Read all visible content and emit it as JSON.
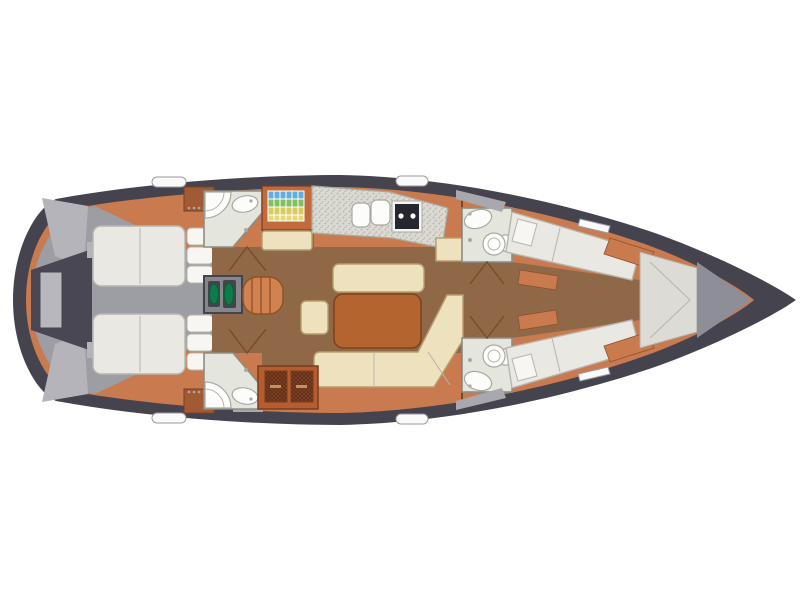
{
  "diagram": {
    "title": "Sailboat interior layout plan (top view, bow to the right)",
    "orientation": "bow-right",
    "areas": [
      {
        "id": "swim-platform",
        "label": "stern transom / swim platform"
      },
      {
        "id": "cockpit",
        "label": "cockpit deck"
      },
      {
        "id": "aft-cabin-top",
        "label": "aft double berth cabin (port)"
      },
      {
        "id": "aft-cabin-bottom",
        "label": "aft double berth cabin (starboard)"
      },
      {
        "id": "aft-head-top",
        "label": "aft head with corner shower and basin"
      },
      {
        "id": "aft-head-bottom",
        "label": "aft head with corner shower and basin"
      },
      {
        "id": "nav-station",
        "label": "chart table with colored chart grid and seat"
      },
      {
        "id": "galley",
        "label": "galley with double sink and two-burner stove"
      },
      {
        "id": "saloon",
        "label": "saloon with U-shaped settee and table"
      },
      {
        "id": "companionway",
        "label": "companionway steps"
      },
      {
        "id": "engine-compartment",
        "label": "engine compartment hatch"
      },
      {
        "id": "storage-cabinet",
        "label": "louvered storage lockers"
      },
      {
        "id": "forward-head-top",
        "label": "forward head with toilet and basin"
      },
      {
        "id": "forward-head-bottom",
        "label": "forward head with toilet and basin"
      },
      {
        "id": "forward-berth-top",
        "label": "forward berth (angled)"
      },
      {
        "id": "forward-berth-bottom",
        "label": "forward berth (angled)"
      },
      {
        "id": "anchor-locker",
        "label": "bow anchor locker"
      }
    ]
  },
  "colors": {
    "background": "#ffffff",
    "hull": "#45444e",
    "cockpit": "#9d9da4",
    "cockpit_panel": "#b4b4ba",
    "transom": "#484753",
    "transom_inner": "#b7b7bd",
    "floor_orange": "#c97a4e",
    "floor_brown": "#8f6947",
    "steps": "#d0824f",
    "steps_edge": "#8f5128",
    "cream": "#eee1bd",
    "cream_edge": "#b59e6e",
    "table": "#b4652f",
    "table_edge": "#7f431c",
    "bed": "#e9e8e3",
    "bed_edge": "#b6b5af",
    "pillow": "#f7f6f2",
    "head_floor": "#e4e6dd",
    "wall": "#8d8d84",
    "fixture": "#fcfcfa",
    "fixture_edge": "#a9a9a1",
    "counter": "#dbdad2",
    "counter_dot": "#b4b3aa",
    "stove": "#26262e",
    "stove_frame": "#f4f4f2",
    "cabinet": "#b55c31",
    "cabinet_edge": "#7a3c1c",
    "door_panel": "#7e3f22",
    "door_line": "#7a4a28",
    "locker": "#a05a34",
    "locker_edge": "#7a4020",
    "engine_box": "#87868d",
    "engine_dark": "#45444d",
    "engine_green": "#0e7c4a",
    "hatch": "#fafafa",
    "hatch_edge": "#9a9aa0",
    "wedge": "#dcdbd5",
    "wedge_edge": "#aeada6",
    "bow_gray": "#8e8e97",
    "sliver": "#a8a8ae",
    "nav_cabinet": "#c06a3e",
    "grid_blue": "#64aede",
    "grid_green": "#84c05e",
    "grid_yellow": "#d8cc5e",
    "grid_pale": "#e4da74"
  }
}
